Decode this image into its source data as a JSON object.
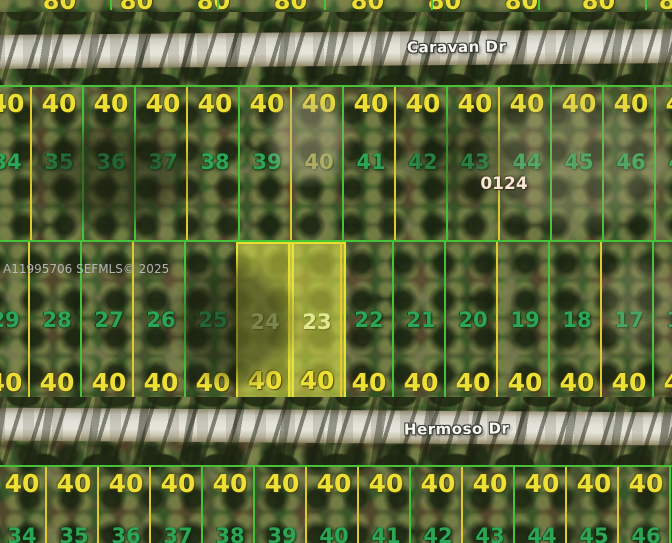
{
  "watermark": "A11995706 SEFMLS© 2025",
  "block_label": "0124",
  "roads": {
    "north": "Caravan Dr",
    "south": "Hermoso Dr"
  },
  "colors": {
    "line_green": "#46c138",
    "line_yellow": "#e2c92f",
    "dim_text": "#ecdf35",
    "lot_number_text": "#2da556",
    "lot_number_alt": "#a9ab45",
    "lot_number_highlight": "#dfe98e",
    "highlight_border": "#e8df2e",
    "highlight_fill": "rgba(223,226,72,0.55)",
    "road_text": "#f7f7f2",
    "block_text": "#f6e8d5",
    "watermark_text": "#c9c9c9"
  },
  "north_band": {
    "dim": "80",
    "lots": [
      {},
      {},
      {},
      {},
      {},
      {},
      {},
      {},
      {}
    ]
  },
  "bands": [
    {
      "name": "row-north-of-hermoso",
      "dim": "40",
      "lots": [
        {
          "n": "34",
          "e": "g"
        },
        {
          "n": "35",
          "e": "y"
        },
        {
          "n": "36",
          "e": "g"
        },
        {
          "n": "37",
          "e": "g"
        },
        {
          "n": "38",
          "e": "y"
        },
        {
          "n": "39",
          "e": "g"
        },
        {
          "n": "40",
          "e": "y",
          "c": "alt"
        },
        {
          "n": "41",
          "e": "g"
        },
        {
          "n": "42",
          "e": "y"
        },
        {
          "n": "43",
          "e": "g"
        },
        {
          "n": "44",
          "e": "y"
        },
        {
          "n": "45",
          "e": "g"
        },
        {
          "n": "46",
          "e": "g"
        },
        {
          "n": "47",
          "e": "g"
        }
      ]
    },
    {
      "name": "row-middle",
      "dim": "40",
      "lots": [
        {
          "n": "29",
          "e": "g"
        },
        {
          "n": "28",
          "e": "y"
        },
        {
          "n": "27",
          "e": "g"
        },
        {
          "n": "26",
          "e": "y"
        },
        {
          "n": "25",
          "e": "g"
        },
        {
          "n": "24",
          "e": "y",
          "hl": true
        },
        {
          "n": "23",
          "e": "y",
          "hl": true
        },
        {
          "n": "22",
          "e": "y"
        },
        {
          "n": "21",
          "e": "g"
        },
        {
          "n": "20",
          "e": "g"
        },
        {
          "n": "19",
          "e": "y"
        },
        {
          "n": "18",
          "e": "g"
        },
        {
          "n": "17",
          "e": "y"
        },
        {
          "n": "16",
          "e": "g"
        }
      ]
    },
    {
      "name": "row-south-of-hermoso",
      "dim": "40",
      "lots": [
        {
          "n": "34",
          "e": "g"
        },
        {
          "n": "35",
          "e": "y"
        },
        {
          "n": "36",
          "e": "y"
        },
        {
          "n": "37",
          "e": "y"
        },
        {
          "n": "38",
          "e": "g"
        },
        {
          "n": "39",
          "e": "g"
        },
        {
          "n": "40",
          "e": "y"
        },
        {
          "n": "41",
          "e": "y"
        },
        {
          "n": "42",
          "e": "g"
        },
        {
          "n": "43",
          "e": "y"
        },
        {
          "n": "44",
          "e": "g"
        },
        {
          "n": "45",
          "e": "y"
        },
        {
          "n": "46",
          "e": "y"
        },
        {
          "n": "47",
          "e": "g"
        }
      ]
    }
  ]
}
